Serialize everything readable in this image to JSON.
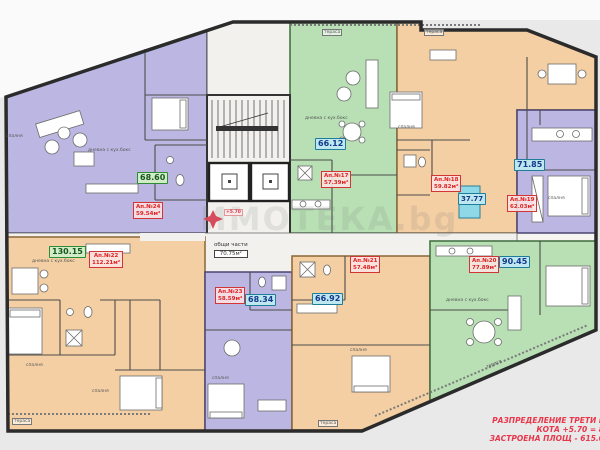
{
  "drawing": {
    "type": "apartment building floor plan",
    "title_block": {
      "line1": "РАЗПРЕДЕЛЕНИЕ ТРЕТИ Е",
      "line2": "КОТА +5.70 = 8",
      "line3": "ЗАСТРОЕНА ПЛОЩ - 615.0"
    },
    "watermark": "ИМОТЕКА.bg",
    "common_area": {
      "name": "общи части",
      "value": "70.75м²"
    },
    "level_marker": "+5.70",
    "apartments": [
      {
        "number": "Ап.№24",
        "net_area": "59.54м²"
      },
      {
        "number": "Ап.№17",
        "net_area": "57.39м²"
      },
      {
        "number": "Ап.№18",
        "net_area": "59.82м²"
      },
      {
        "number": "Ап.№19",
        "net_area": "62.03м²"
      },
      {
        "number": "Ап.№20",
        "net_area": "77.89м²"
      },
      {
        "number": "Ап.№21",
        "net_area": "57.48м²"
      },
      {
        "number": "Ап.№22",
        "net_area": "112.21м²"
      },
      {
        "number": "Ап.№23",
        "net_area": "58.59м²"
      }
    ],
    "area_badges": [
      {
        "value": "68.60",
        "style": "green"
      },
      {
        "value": "130.15",
        "style": "green"
      },
      {
        "value": "66.12",
        "style": "cyan"
      },
      {
        "value": "71.85",
        "style": "cyan"
      },
      {
        "value": "37.77",
        "style": "cyan"
      },
      {
        "value": "90.45",
        "style": "cyan"
      },
      {
        "value": "66.92",
        "style": "cyan"
      },
      {
        "value": "68.34",
        "style": "cyan"
      }
    ],
    "rooms": [
      {
        "text": "спалня"
      },
      {
        "text": "дневна с кух.бокс"
      },
      {
        "text": "дневна с кух.бокс"
      },
      {
        "text": "спалня"
      },
      {
        "text": "спалня"
      },
      {
        "text": "дневна с кух.бокс"
      },
      {
        "text": "спалня"
      },
      {
        "text": "спалня"
      },
      {
        "text": "спалня"
      },
      {
        "text": "спалня"
      },
      {
        "text": "дневна с кух.бокс"
      },
      {
        "text": "тераса"
      },
      {
        "text": "тераса"
      },
      {
        "text": "тераса"
      },
      {
        "text": "тераса"
      },
      {
        "text": "тераса"
      }
    ],
    "colors": {
      "apartment_purple": "#bcb6e2",
      "apartment_green": "#b8e0b4",
      "apartment_orange": "#f4cfa4",
      "terrace_blue": "#8ed8e8",
      "label_red": "#d23535",
      "title_red": "#e8364b"
    }
  }
}
